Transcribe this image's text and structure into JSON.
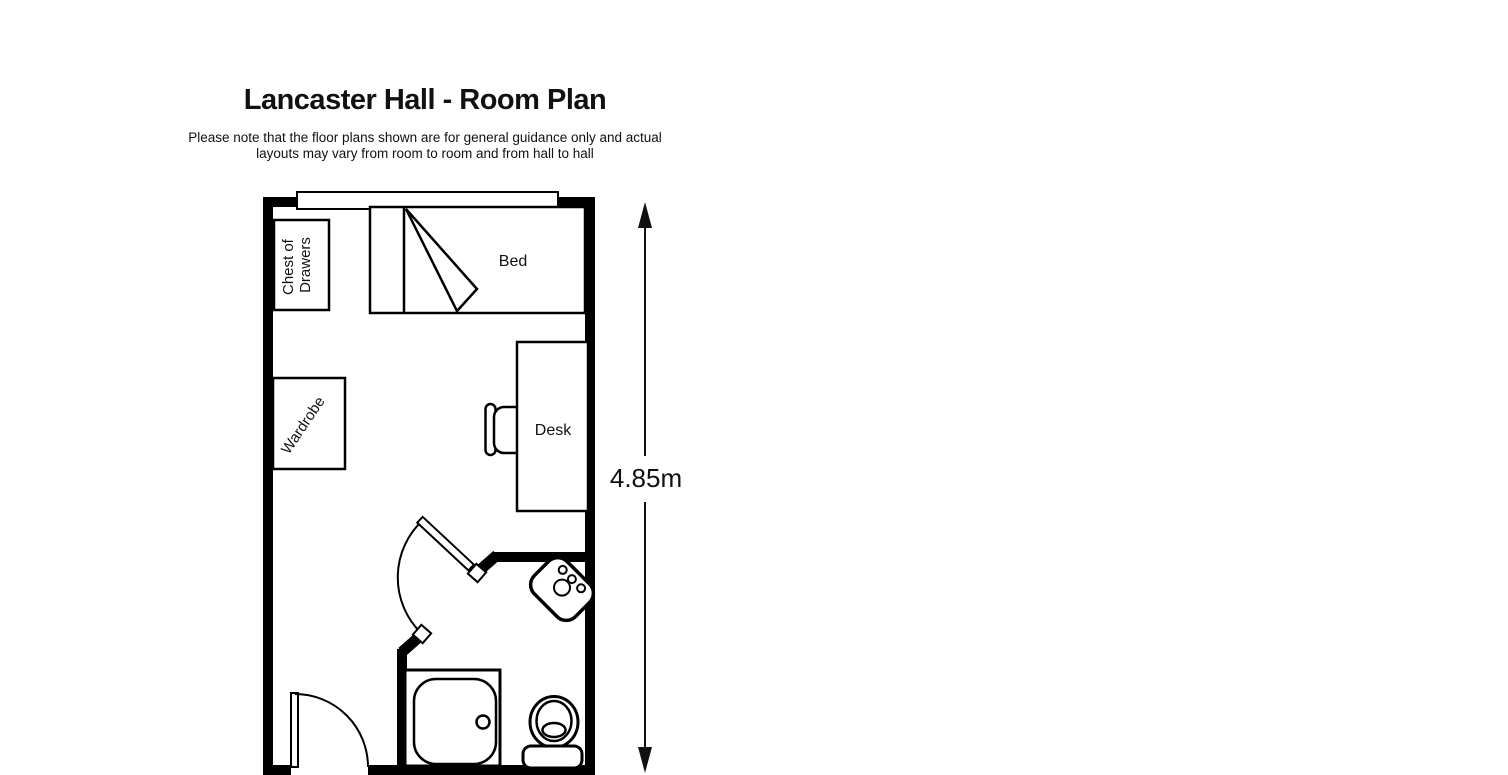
{
  "header": {
    "title": "Lancaster Hall - Room Plan",
    "disclaimer_line1": "Please note that the floor plans shown are for general guidance only and actual",
    "disclaimer_line2": "layouts may vary from room to room and from hall to hall"
  },
  "floor_plan": {
    "colors": {
      "line": "#000000",
      "fill": "#ffffff"
    },
    "labels": {
      "chest_line1": "Chest of",
      "chest_line2": "Drawers",
      "bed": "Bed",
      "wardrobe": "Wardrobe",
      "desk": "Desk"
    },
    "fixtures": [
      "window",
      "chest-of-drawers",
      "bed",
      "wardrobe",
      "desk",
      "desk-chair",
      "bathroom-door",
      "sink",
      "shower",
      "toilet",
      "entry-door"
    ],
    "dimension": {
      "label": "4.85m",
      "axis": "vertical"
    }
  }
}
